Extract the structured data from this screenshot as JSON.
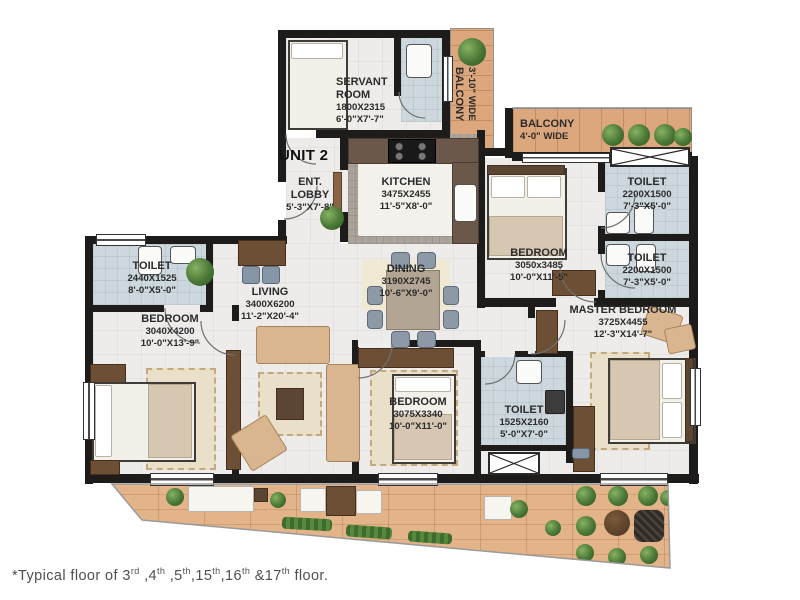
{
  "unit": {
    "label": "UNIT 2"
  },
  "footnote": {
    "p1": "*Typical floor of 3",
    "s1": "rd",
    "p2": " ,4",
    "s2": "th",
    "p3": " ,5",
    "s3": "th",
    "p4": ",15",
    "s4": "th",
    "p5": ",16",
    "s5": "th",
    "p6": " &17",
    "s6": "th",
    "p7": " floor."
  },
  "rooms": {
    "servant_room": {
      "name": "SERVANT ROOM",
      "dim_mm": "1800X2315",
      "dim_ft": "6'-0\"X7'-7\""
    },
    "ent_lobby": {
      "name": "ENT. LOBBY",
      "dim_ft": "5'-3\"X7'-8\""
    },
    "kitchen": {
      "name": "KITCHEN",
      "dim_mm": "3475X2455",
      "dim_ft": "11'-5\"X8'-0\""
    },
    "dining": {
      "name": "DINING",
      "dim_mm": "3190X2745",
      "dim_ft": "10'-6\"X9'-0\""
    },
    "living": {
      "name": "LIVING",
      "dim_mm": "3400X6200",
      "dim_ft": "11'-2\"X20'-4\""
    },
    "toilet_left": {
      "name": "TOILET",
      "dim_mm": "2440X1525",
      "dim_ft": "8'-0\"X5'-0\""
    },
    "bedroom_left": {
      "name": "BEDROOM",
      "dim_mm": "3040X4200",
      "dim_ft": "10'-0\"X13'-9\""
    },
    "bedroom_middle": {
      "name": "BEDROOM",
      "dim_mm": "3075X3340",
      "dim_ft": "10'-0\"X11'-0\""
    },
    "toilet_middle": {
      "name": "TOILET",
      "dim_mm": "1525X2160",
      "dim_ft": "5'-0\"X7'-0\""
    },
    "bedroom_right": {
      "name": "BEDROOM",
      "dim_mm": "3050x3485",
      "dim_ft": "10'-0\"X11'-5\""
    },
    "toilet_right_top": {
      "name": "TOILET",
      "dim_mm": "2200X1500",
      "dim_ft": "7'-3\"X5'-0\""
    },
    "toilet_right_bottom": {
      "name": "TOILET",
      "dim_mm": "2200X1500",
      "dim_ft": "7'-3\"X5'-0\""
    },
    "master_bedroom": {
      "name": "MASTER BEDROOM",
      "dim_mm": "3725X4455",
      "dim_ft": "12'-3\"X14'-7\""
    },
    "balcony_top": {
      "name": "BALCONY",
      "width": "4'-0\" WIDE"
    },
    "balcony_side": {
      "name": "BALCONY",
      "width": "3'-10\" WIDE"
    }
  }
}
